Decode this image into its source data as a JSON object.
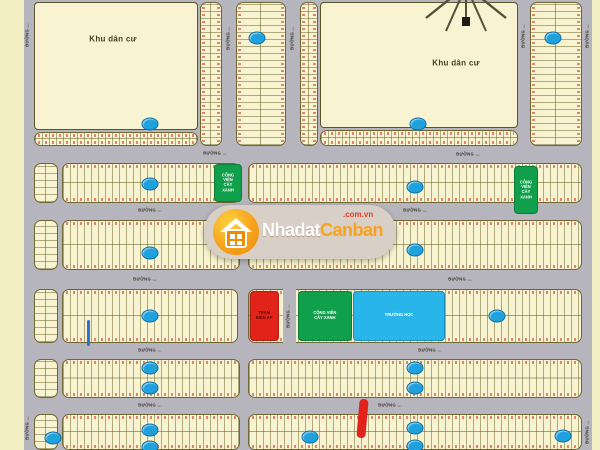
{
  "map": {
    "region_label": "Khu dân cư",
    "road_label": "ĐƯỜNG ...",
    "zones": {
      "park_line1": "CÔNG VIÊN",
      "park_line2": "CÂY XANH",
      "school_label": "TRƯỜNG HỌC",
      "substation_line1": "TRẠM",
      "substation_line2": "BIẾN ÁP"
    },
    "colors": {
      "background_cream": "#f4eec5",
      "road_gray": "#b6b4bd",
      "block_fill": "#f8f3d0",
      "badge_blue": "#1ea1dd",
      "park_green": "#109f4a",
      "school_cyan": "#28b5e9",
      "substation_red": "#e2231a",
      "tick_salmon": "#dd7860"
    }
  },
  "watermark": {
    "brand_left": "Nhadat",
    "brand_right": "Canban",
    "domain_suffix": ".com.vn"
  }
}
